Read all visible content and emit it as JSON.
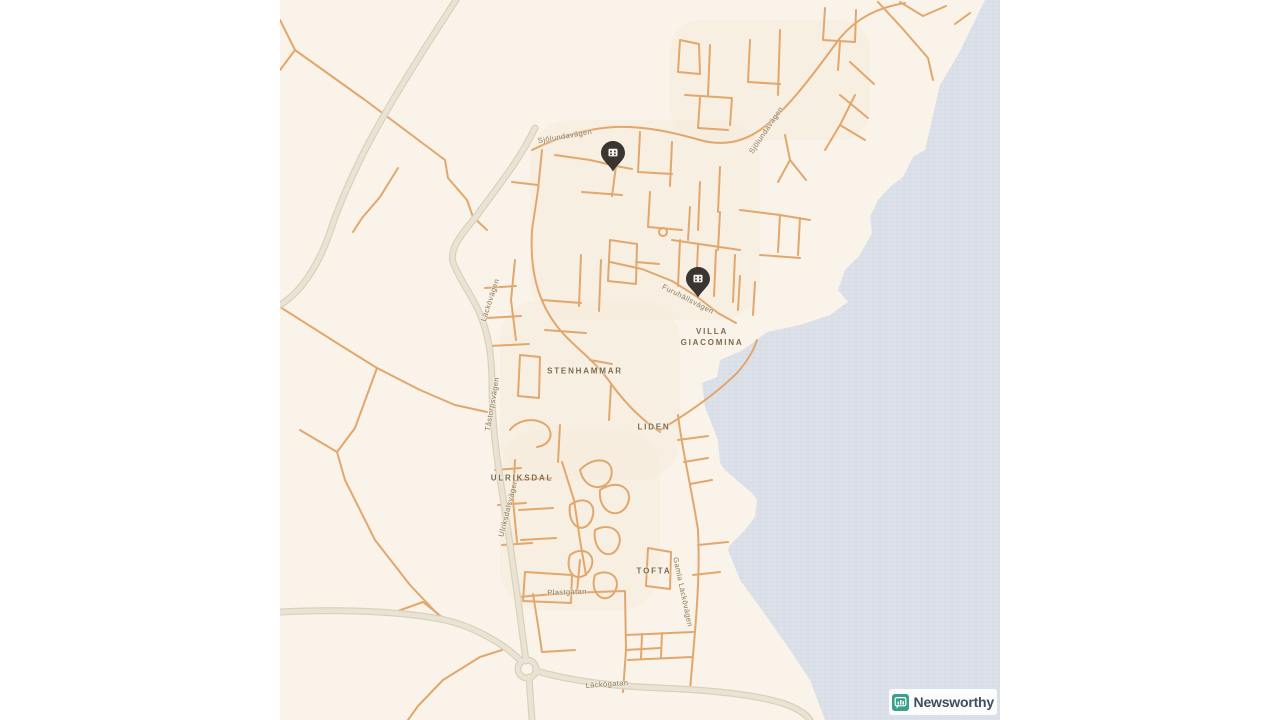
{
  "page": {
    "width": 1280,
    "height": 720,
    "background": "#ffffff"
  },
  "map": {
    "left": 280,
    "top": 0,
    "width": 720,
    "height": 720,
    "colors": {
      "land": "#faf3e9",
      "water": "#dce1e9",
      "water_line": "#d0d8e3",
      "road_minor": "#e2a76d",
      "road_major_fill": "#eae3d4",
      "road_major_casing": "#d8d1bd",
      "place_label": "#7d6a4c",
      "road_label": "#8b7857",
      "pin": "#3a3531",
      "pin_glyph": "#f7f3ec"
    },
    "labels": [
      {
        "text": "Sjölundavägen",
        "x": 285,
        "y": 136,
        "rot": -10,
        "type": "road"
      },
      {
        "text": "Sjölundavägen",
        "x": 486,
        "y": 130,
        "rot": -56,
        "type": "road"
      },
      {
        "text": "Furuhällsvägen",
        "x": 408,
        "y": 299,
        "rot": 27,
        "type": "road"
      },
      {
        "text": "Läckövägen",
        "x": 210,
        "y": 300,
        "rot": -72,
        "type": "road"
      },
      {
        "text": "Tåstorpsvägen",
        "x": 212,
        "y": 404,
        "rot": -80,
        "type": "road"
      },
      {
        "text": "Ulriksdalsvägen",
        "x": 228,
        "y": 508,
        "rot": -76,
        "type": "road"
      },
      {
        "text": "Gamla Läckövägen",
        "x": 403,
        "y": 592,
        "rot": 78,
        "type": "road"
      },
      {
        "text": "Plastgatan",
        "x": 287,
        "y": 592,
        "rot": -2,
        "type": "road"
      },
      {
        "text": "Läckögatan",
        "x": 327,
        "y": 684,
        "rot": -4,
        "type": "road"
      },
      {
        "text": "STENHAMMAR",
        "x": 305,
        "y": 371,
        "rot": 0,
        "type": "place"
      },
      {
        "text": "LIDEN",
        "x": 374,
        "y": 427,
        "rot": 0,
        "type": "place"
      },
      {
        "text": "ULRIKSDAL",
        "x": 242,
        "y": 478,
        "rot": 0,
        "type": "place"
      },
      {
        "text": "TOFTA",
        "x": 374,
        "y": 571,
        "rot": 0,
        "type": "place"
      },
      {
        "text": "VILLA\nGIACOMINA",
        "x": 432,
        "y": 337,
        "rot": 0,
        "type": "place"
      }
    ],
    "markers": [
      {
        "x": 333,
        "y": 171,
        "icon": "building-pin-icon"
      },
      {
        "x": 418,
        "y": 297,
        "icon": "building-pin-icon"
      }
    ]
  },
  "attribution": {
    "name": "Newsworthy",
    "icon": "newsworthy-chart-badge-icon",
    "badge_color": "#3b9e8e",
    "logo_text": "#3d4f5d"
  }
}
